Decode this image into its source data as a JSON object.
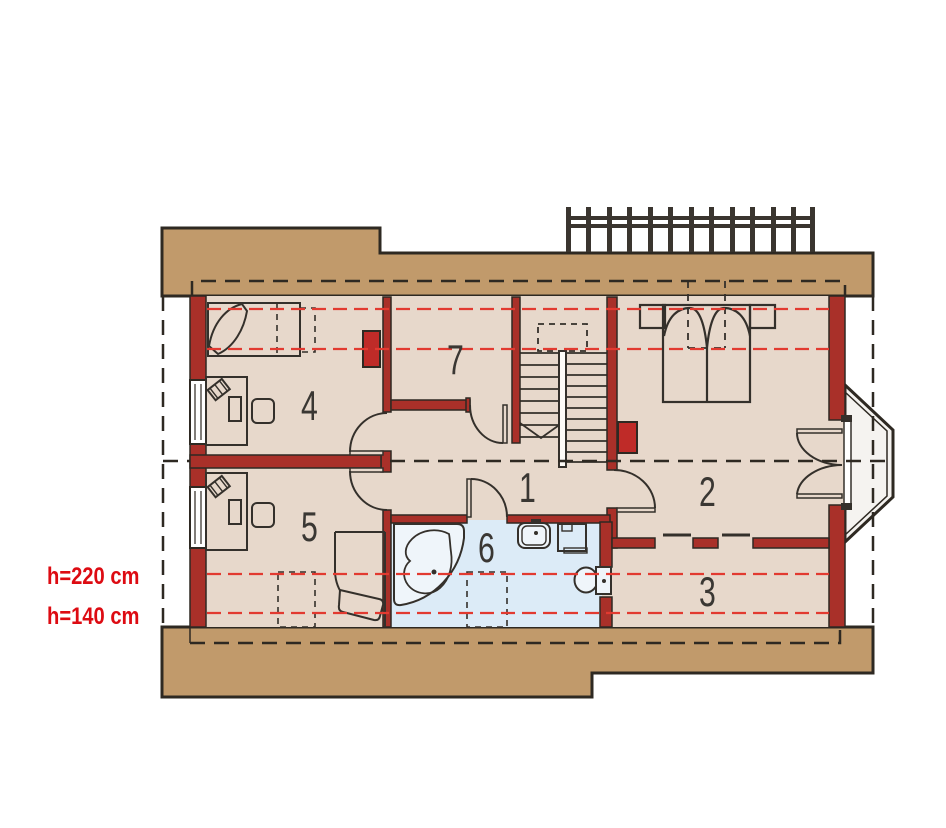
{
  "plan": {
    "rooms": {
      "r1": {
        "label": "1"
      },
      "r2": {
        "label": "2"
      },
      "r3": {
        "label": "3"
      },
      "r4": {
        "label": "4"
      },
      "r5": {
        "label": "5"
      },
      "r6": {
        "label": "6"
      },
      "r7": {
        "label": "7"
      }
    },
    "annotations": {
      "h220": "h=220 cm",
      "h140": "h=140 cm"
    },
    "palette": {
      "roof_tan": "#C19A6B",
      "floor_beige": "#E7D8CB",
      "bathroom_blue": "#DCEBF7",
      "bay_glass": "#F5F3F0",
      "wall_red": "#A93029",
      "chimney_red": "#BF2B28",
      "height_line_red": "#E23A30",
      "line_dark": "#2E2922",
      "fixture_fill": "#EFF5FA",
      "handrail_white": "#FDFBF7",
      "label_red": "#DD0B12",
      "label_gray": "#3A3733"
    }
  }
}
